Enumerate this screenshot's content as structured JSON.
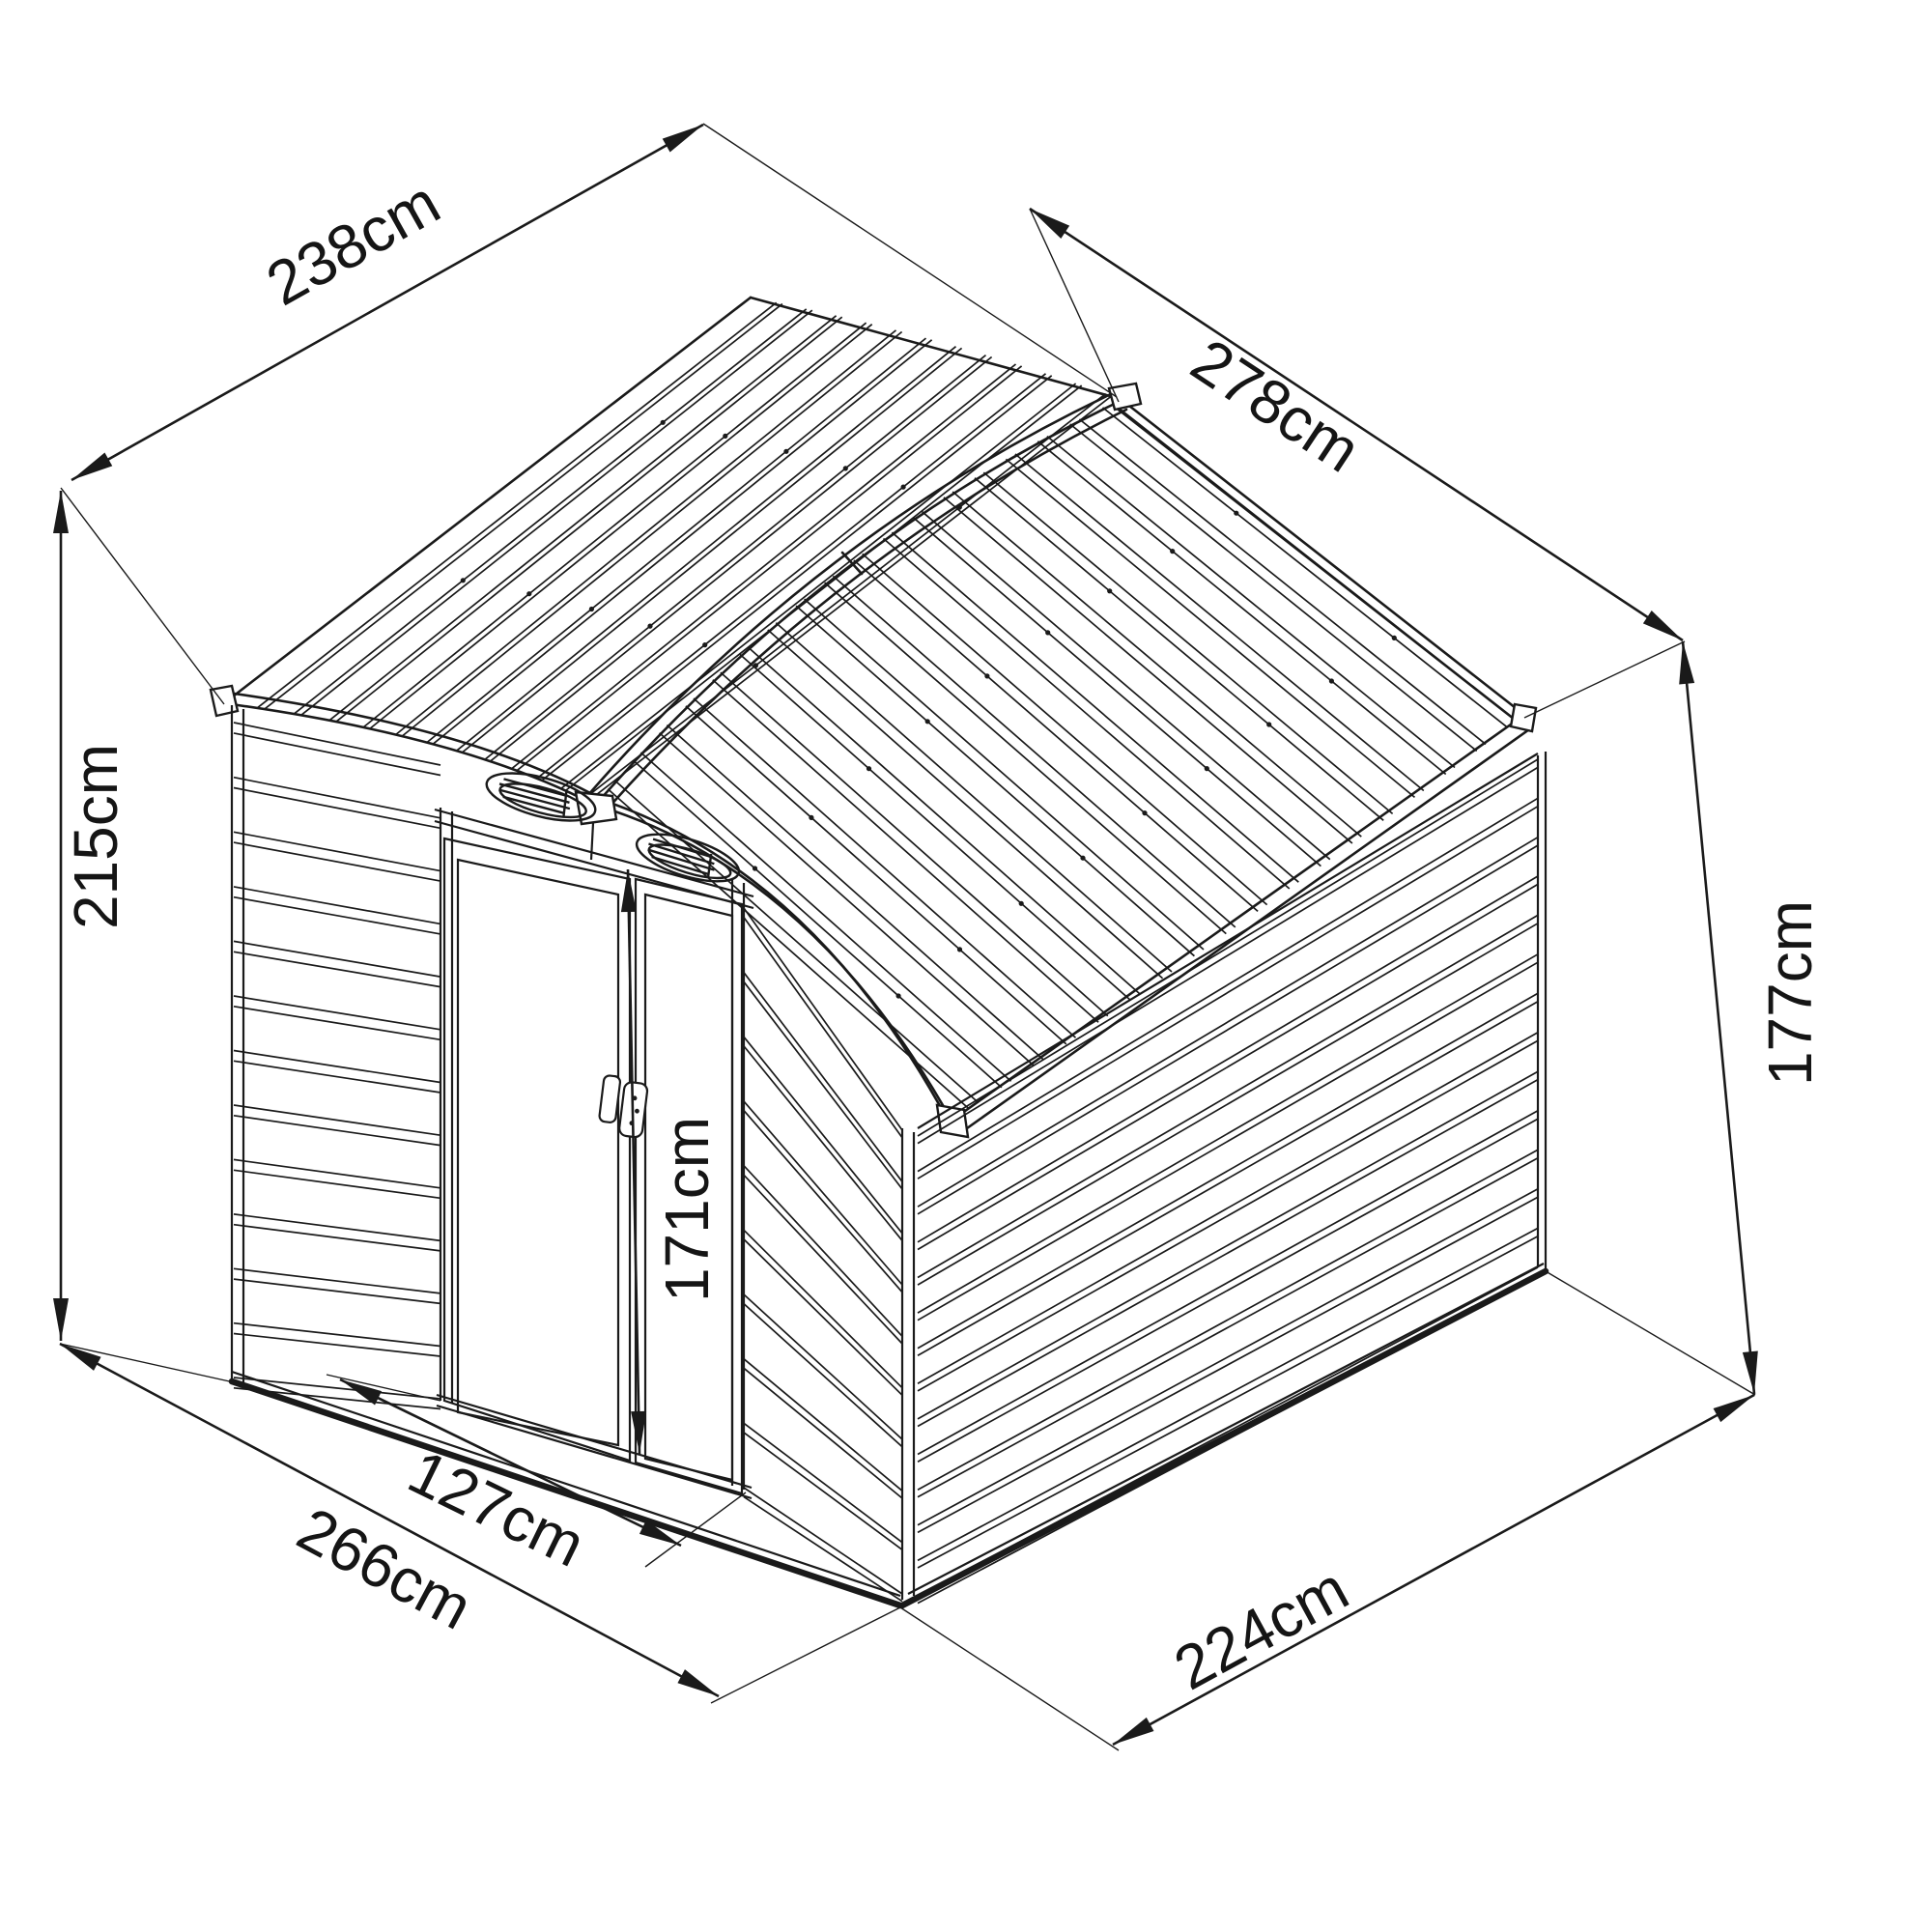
{
  "diagram": {
    "type": "isometric-dimension-drawing",
    "subject": "metal garden shed with gabled roof, two louvered gable vents and sliding double doors",
    "unit": "cm",
    "background_color": "#ffffff",
    "line_color": "#1a1a1a",
    "dimensions": {
      "roof_width": {
        "label": "238cm",
        "value": 238,
        "location": "top-left, along roof slope width"
      },
      "roof_length": {
        "label": "278cm",
        "value": 278,
        "location": "top-right, along roof length"
      },
      "total_height": {
        "label": "215cm",
        "value": 215,
        "location": "left, overall height to ridge"
      },
      "wall_height": {
        "label": "177cm",
        "value": 177,
        "location": "right, eave / wall height"
      },
      "door_height": {
        "label": "171cm",
        "value": 171,
        "location": "center, door opening height"
      },
      "door_width": {
        "label": "127cm",
        "value": 127,
        "location": "bottom-center, door opening width"
      },
      "base_width": {
        "label": "266cm",
        "value": 266,
        "location": "bottom-left, base width"
      },
      "base_depth": {
        "label": "224cm",
        "value": 224,
        "location": "bottom-right, base depth"
      }
    },
    "features": {
      "vents": 2,
      "doors": 2,
      "door_type": "sliding",
      "roof_type": "gabled, ribbed metal panels",
      "walls": "horizontal ribbed metal siding"
    }
  }
}
